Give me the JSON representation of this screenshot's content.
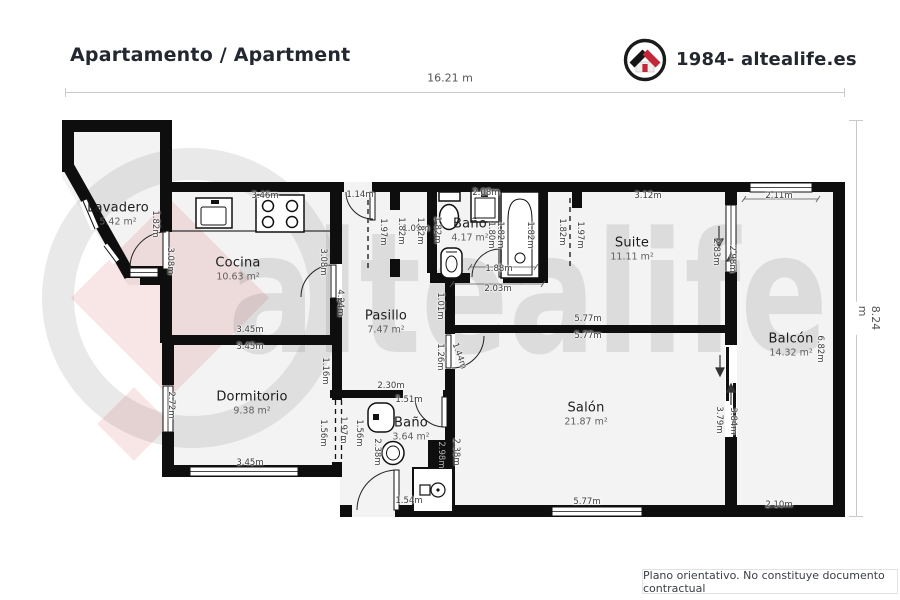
{
  "header": {
    "title": "Apartamento / Apartment",
    "brand": "1984- altealife.es"
  },
  "watermark": {
    "text": "altealife"
  },
  "dimensions_overall": {
    "width_label": "16.21 m",
    "height_label": "8.24 m"
  },
  "footer": {
    "disclaimer": "Plano orientativo. No constituye documento contractual"
  },
  "colors": {
    "wall": "#0e0e0e",
    "brand_red": "#c32737",
    "floor": "#f3f3f3"
  },
  "plan": {
    "rooms": [
      {
        "name": "Lavadero",
        "area": "5.42 m²",
        "x": 118,
        "y": 214
      },
      {
        "name": "Cocina",
        "area": "10.63 m²",
        "x": 238,
        "y": 269
      },
      {
        "name": "Baño",
        "area": "4.17 m²",
        "x": 470,
        "y": 230
      },
      {
        "name": "Suite",
        "area": "11.11 m²",
        "x": 632,
        "y": 249
      },
      {
        "name": "Pasillo",
        "area": "7.47 m²",
        "x": 386,
        "y": 322
      },
      {
        "name": "Dormitorio",
        "area": "9.38 m²",
        "x": 252,
        "y": 403
      },
      {
        "name": "Baño",
        "area": "3.64 m²",
        "x": 411,
        "y": 429
      },
      {
        "name": "Salón",
        "area": "21.87 m²",
        "x": 586,
        "y": 414
      },
      {
        "name": "Balcón",
        "area": "14.32 m²",
        "x": 791,
        "y": 345
      }
    ],
    "dimension_labels": [
      {
        "text": "3.46m",
        "x": 265,
        "y": 196
      },
      {
        "text": "1.14m",
        "x": 360,
        "y": 195
      },
      {
        "text": "2.08m",
        "x": 486,
        "y": 193
      },
      {
        "text": "3.12m",
        "x": 648,
        "y": 196
      },
      {
        "text": "2.11m",
        "x": 779,
        "y": 196
      },
      {
        "text": "1.09m",
        "x": 416,
        "y": 229
      },
      {
        "text": "1.88m",
        "x": 499,
        "y": 269
      },
      {
        "text": "2.03m",
        "x": 498,
        "y": 289
      },
      {
        "text": "3.45m",
        "x": 250,
        "y": 330
      },
      {
        "text": "3.45m",
        "x": 250,
        "y": 347
      },
      {
        "text": "5.77m",
        "x": 588,
        "y": 319
      },
      {
        "text": "5.77m",
        "x": 588,
        "y": 336
      },
      {
        "text": "2.30m",
        "x": 391,
        "y": 386
      },
      {
        "text": "1.51m",
        "x": 409,
        "y": 400
      },
      {
        "text": "3.45m",
        "x": 250,
        "y": 463
      },
      {
        "text": "1.54m",
        "x": 409,
        "y": 501
      },
      {
        "text": "5.77m",
        "x": 587,
        "y": 502
      },
      {
        "text": "2.10m",
        "x": 779,
        "y": 505
      },
      {
        "text": "1.82m",
        "x": 155,
        "y": 224,
        "rot": 90
      },
      {
        "text": "3.08m",
        "x": 170,
        "y": 261,
        "rot": 90
      },
      {
        "text": "3.08m",
        "x": 323,
        "y": 262,
        "rot": 90
      },
      {
        "text": "4.24m",
        "x": 340,
        "y": 303,
        "rot": 90
      },
      {
        "text": "1.97m",
        "x": 383,
        "y": 232,
        "rot": 90
      },
      {
        "text": "1.82m",
        "x": 401,
        "y": 231,
        "rot": 90
      },
      {
        "text": "1.82m",
        "x": 420,
        "y": 231,
        "rot": 90
      },
      {
        "text": "1.82m",
        "x": 437,
        "y": 230,
        "rot": 90
      },
      {
        "text": "1.80m",
        "x": 491,
        "y": 235,
        "rot": 90
      },
      {
        "text": "1.82m",
        "x": 500,
        "y": 235,
        "rot": 90
      },
      {
        "text": "1.82m",
        "x": 530,
        "y": 235,
        "rot": 90
      },
      {
        "text": "1.82m",
        "x": 562,
        "y": 232,
        "rot": 90
      },
      {
        "text": "1.97m",
        "x": 580,
        "y": 235,
        "rot": 90
      },
      {
        "text": "2.83m",
        "x": 716,
        "y": 252,
        "rot": 90
      },
      {
        "text": "2.98m",
        "x": 732,
        "y": 259,
        "rot": 90
      },
      {
        "text": "6.82m",
        "x": 820,
        "y": 349,
        "rot": 90
      },
      {
        "text": "2.72m",
        "x": 171,
        "y": 405,
        "rot": 90
      },
      {
        "text": "1.16m",
        "x": 325,
        "y": 371,
        "rot": 90
      },
      {
        "text": "1.56m",
        "x": 323,
        "y": 433,
        "rot": 90
      },
      {
        "text": "1.97m",
        "x": 343,
        "y": 430,
        "rot": 90
      },
      {
        "text": "1.56m",
        "x": 359,
        "y": 433,
        "rot": 90
      },
      {
        "text": "1.01m",
        "x": 440,
        "y": 306,
        "rot": 90
      },
      {
        "text": "1.26m",
        "x": 440,
        "y": 357,
        "rot": 90
      },
      {
        "text": "1.44m",
        "x": 459,
        "y": 356,
        "rot": 70
      },
      {
        "text": "2.38m",
        "x": 377,
        "y": 452,
        "rot": 90
      },
      {
        "text": "2.98m",
        "x": 441,
        "y": 455,
        "rot": 90,
        "light": true
      },
      {
        "text": "2.38m",
        "x": 456,
        "y": 452,
        "rot": 90
      },
      {
        "text": "3.79m",
        "x": 719,
        "y": 420,
        "rot": 90
      },
      {
        "text": "3.84m",
        "x": 733,
        "y": 421,
        "rot": 90
      }
    ]
  }
}
